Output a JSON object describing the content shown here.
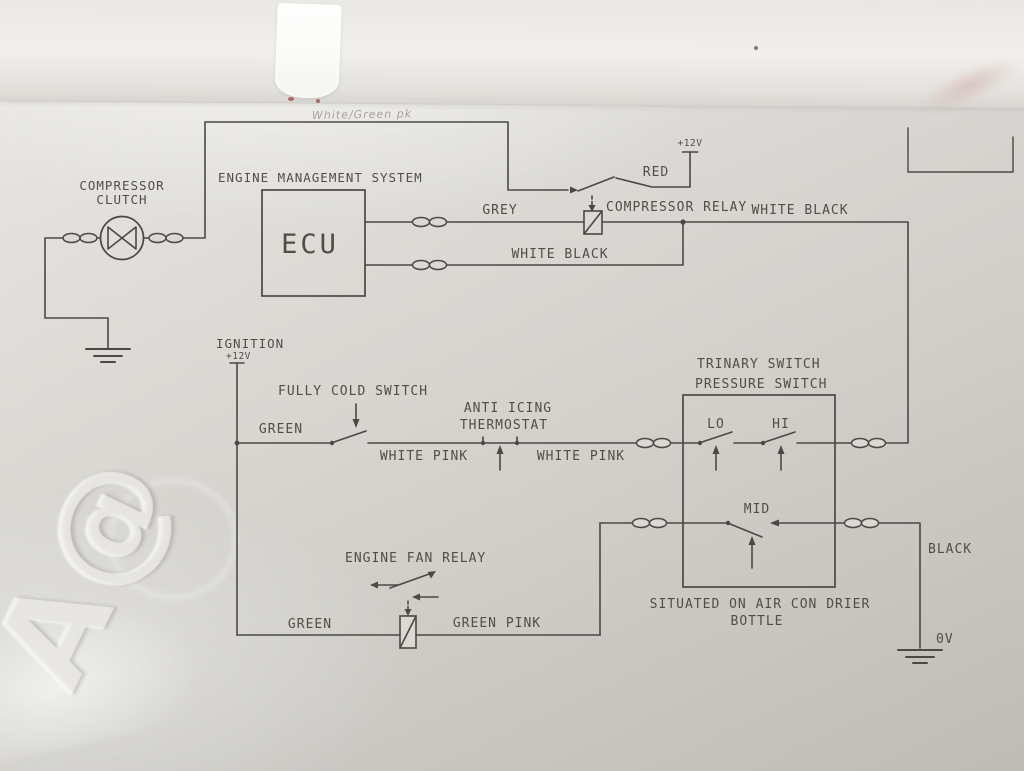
{
  "photo": {
    "watermark": "A@",
    "handwritten_note": "White/Green pk"
  },
  "colors": {
    "paper": "#d8d6d1",
    "paper_top_strip": "#efede9",
    "schematic_line": "#4b4944",
    "schematic_text": "#514e48",
    "red_pen_mark": "#a04043",
    "watermark_emboss": "#f6f5f1"
  },
  "labels": {
    "compressor_clutch_1": "COMPRESSOR",
    "compressor_clutch_2": "CLUTCH",
    "engine_management_system": "ENGINE MANAGEMENT SYSTEM",
    "ecu": "ECU",
    "grey": "GREY",
    "white_black_ecu": "WHITE BLACK",
    "red": "RED",
    "relay_supply": "+12V",
    "compressor_relay": "COMPRESSOR RELAY",
    "white_black_right": "WHITE BLACK",
    "ignition": "IGNITION",
    "ignition_supply": "+12V",
    "fully_cold_switch": "FULLY COLD SWITCH",
    "green_top": "GREEN",
    "white_pink_left": "WHITE PINK",
    "anti_icing_1": "ANTI ICING",
    "anti_icing_2": "THERMOSTAT",
    "white_pink_right": "WHITE PINK",
    "trinary_1": "TRINARY SWITCH",
    "trinary_2": "PRESSURE SWITCH",
    "lo": "LO",
    "hi": "HI",
    "mid": "MID",
    "situated_1": "SITUATED ON AIR CON DRIER",
    "situated_2": "BOTTLE",
    "black": "BLACK",
    "zero_volts": "0V",
    "engine_fan_relay": "ENGINE FAN RELAY",
    "green_bottom": "GREEN",
    "green_pink": "GREEN PINK"
  }
}
